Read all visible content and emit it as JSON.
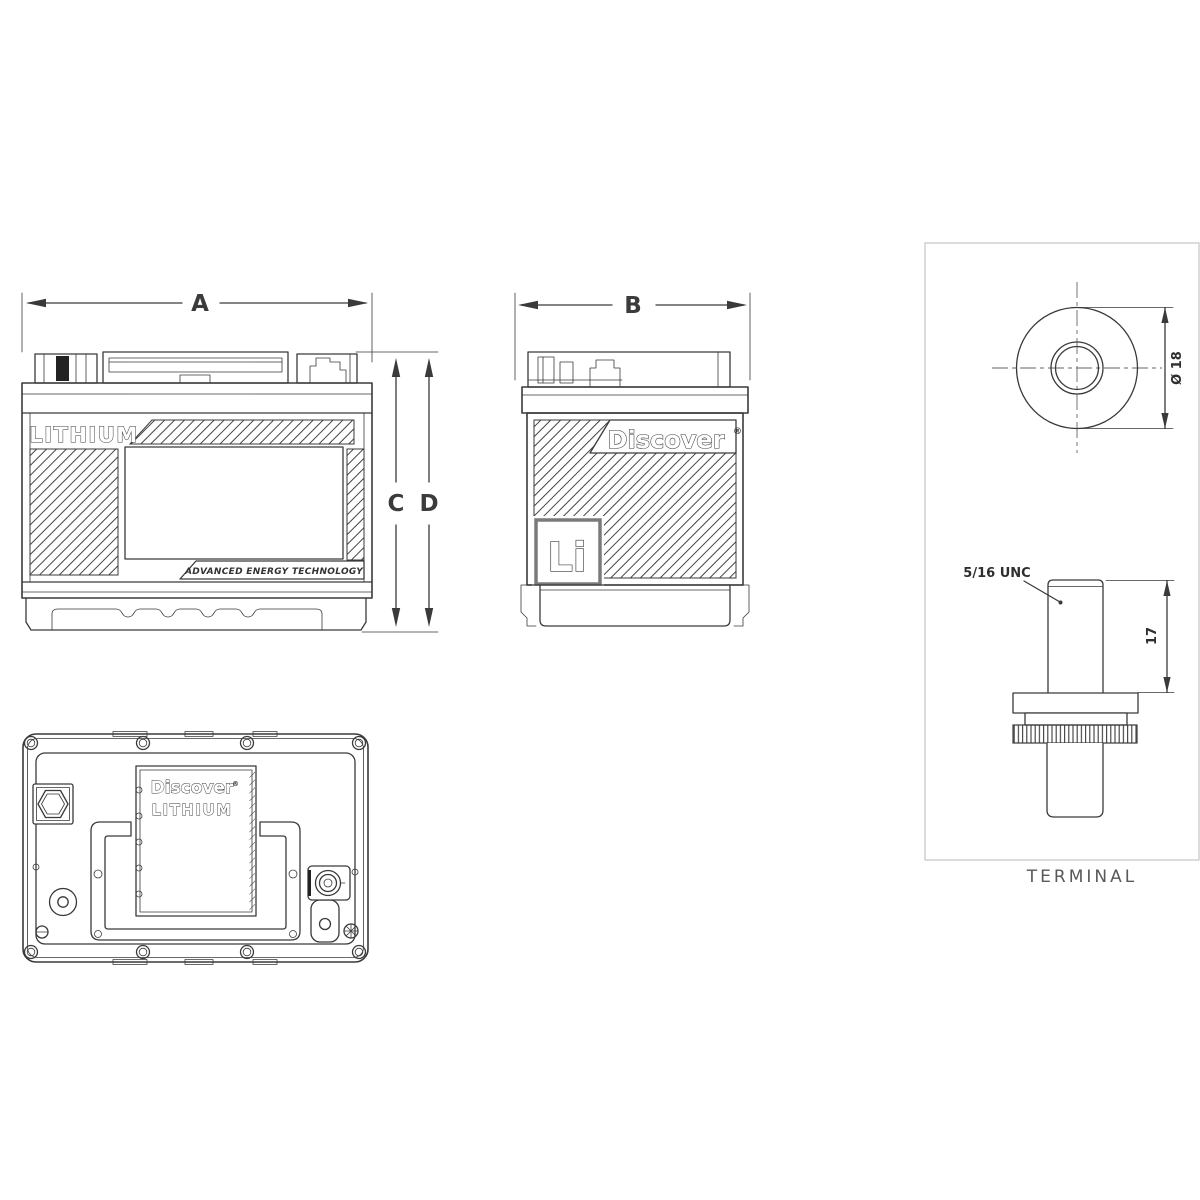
{
  "front_view": {
    "width_dim": "A",
    "height_dim_inner": "C",
    "height_dim_outer": "D",
    "brand": "LITHIUM",
    "tagline": "ADVANCED ENERGY TECHNOLOGY"
  },
  "side_view": {
    "width_dim": "B",
    "brand": "Discover",
    "trademark": "®",
    "chemistry": "Li"
  },
  "top_view": {
    "brand_line1": "Discover",
    "brand_line2": "LITHIUM",
    "trademark": "®"
  },
  "terminal_detail": {
    "caption": "TERMINAL",
    "post_diameter": "Ø 18",
    "thread_spec": "5/16 UNC",
    "stud_height": "17"
  },
  "colors": {
    "line": "#3a3a3a",
    "panel_border": "#c5c5c5",
    "caption_text": "#595959",
    "terminal_mark": "#222222",
    "background": "#ffffff"
  }
}
